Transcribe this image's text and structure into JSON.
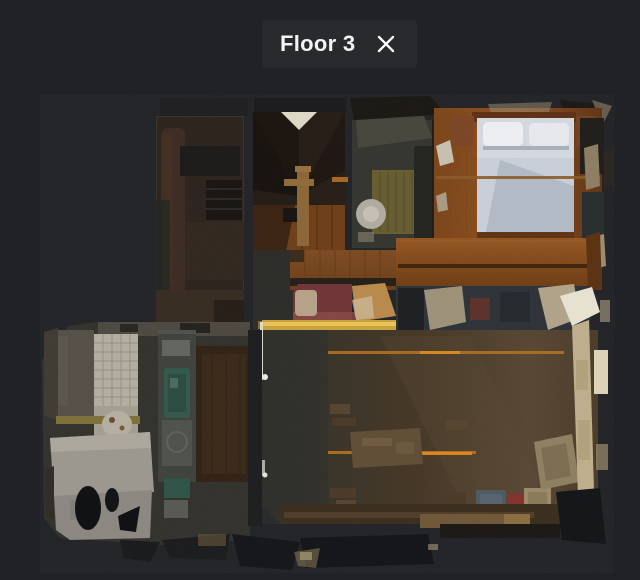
{
  "header": {
    "floor_label": "Floor 3"
  },
  "theme": {
    "background": "#212226",
    "chip_background": "#292a2d",
    "text_color": "#f4f4f4",
    "icon_color": "#ffffff"
  },
  "floorplan": {
    "view": "top-down 3D scan preview",
    "regions": [
      "staircase",
      "storage-room",
      "bathroom",
      "bedroom",
      "bed",
      "red-sofa",
      "living-room",
      "dining-table",
      "kitchen",
      "tiled-washroom"
    ]
  }
}
